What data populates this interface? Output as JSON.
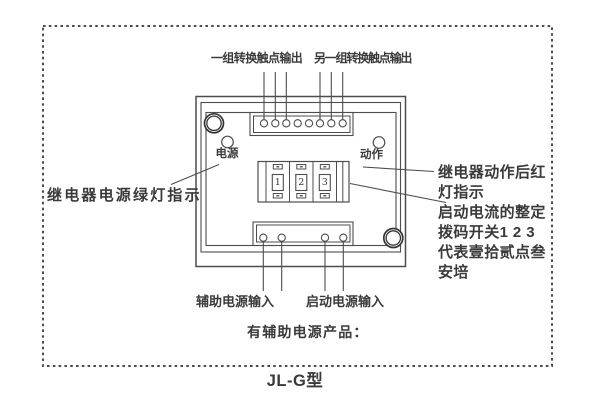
{
  "title": "JL-G型",
  "top_labels": {
    "contact_group_1": "一组转换触点输出",
    "contact_group_2": "另一组转换触点输出"
  },
  "device": {
    "power_led_label": "电源",
    "action_led_label": "动作",
    "dip_digits": [
      "1",
      "2",
      "3"
    ]
  },
  "notes": {
    "left": "继电器电源绿灯指示",
    "right_lines": [
      "继电器动作后红",
      "灯指示",
      "启动电流的整定",
      "拨码开关1 2 3",
      "代表壹拾贰点叁",
      "安培"
    ],
    "bottom_aux": "辅助电源输入",
    "bottom_start": "启动电源输入",
    "bottom_product": "有辅助电源产品："
  },
  "colors": {
    "line": "#4d4d4d",
    "text": "#3a3a3a",
    "screw": "#333333",
    "background": "#ffffff"
  }
}
